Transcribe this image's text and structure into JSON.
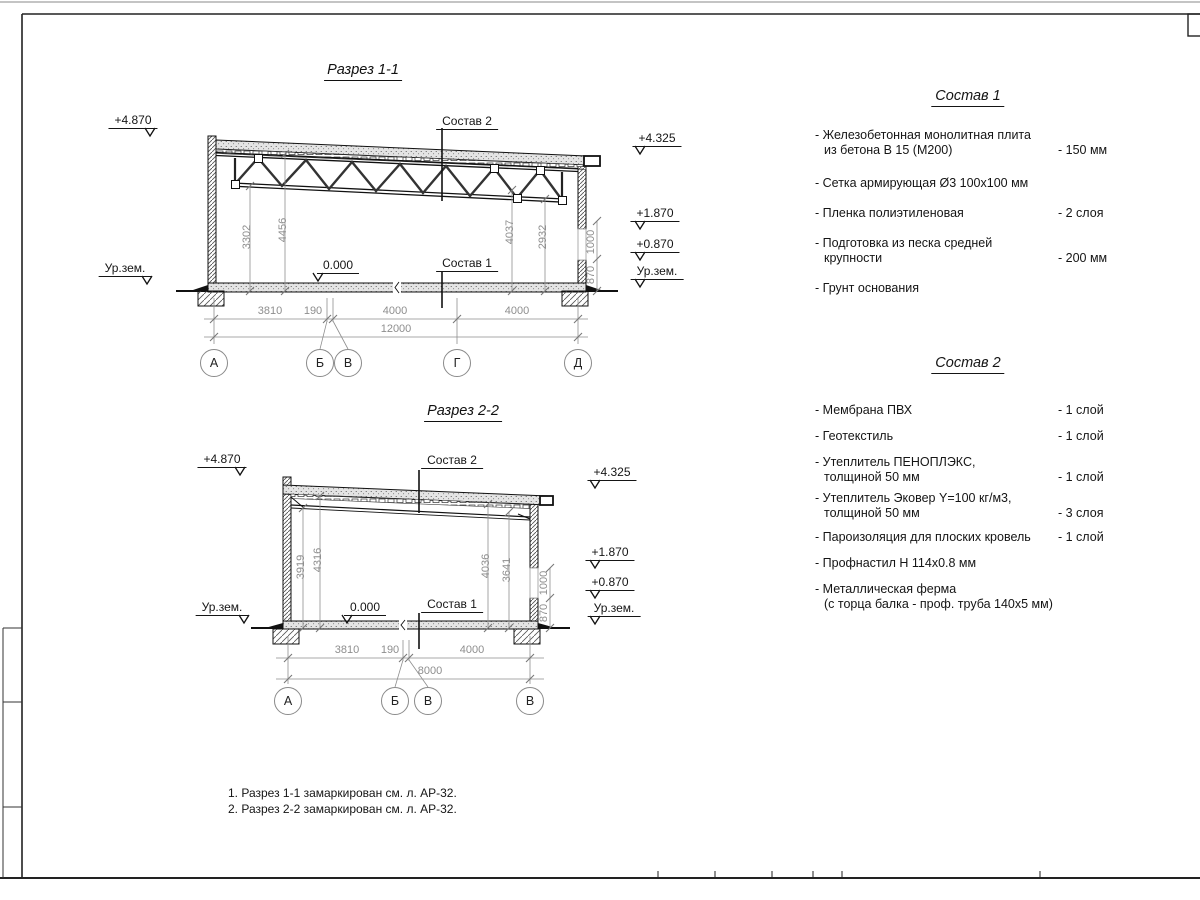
{
  "labels": {
    "ur_zem": "Ур.зем.",
    "zero": "0.000",
    "sostav1_ref": "Состав 1",
    "sostav2_ref": "Состав 2"
  },
  "section1": {
    "title": "Разрез 1-1",
    "elev_left": "+4.870",
    "elev_right_top": "+4.325",
    "elev_right_mid": "+1.870",
    "elev_right_low": "+0.870",
    "vdims": [
      "3302",
      "4456",
      "4037",
      "2932"
    ],
    "wall_dims": [
      "870",
      "1000"
    ],
    "dims": [
      "3810",
      "190",
      "4000",
      "4000"
    ],
    "total": "12000",
    "axes": [
      "А",
      "Б",
      "В",
      "Г",
      "Д"
    ]
  },
  "section2": {
    "title": "Разрез 2-2",
    "elev_left": "+4.870",
    "elev_right_top": "+4.325",
    "elev_right_mid": "+1.870",
    "elev_right_low": "+0.870",
    "vdims": [
      "3919",
      "4316",
      "4036",
      "3641"
    ],
    "wall_dims": [
      "870",
      "1000"
    ],
    "dims": [
      "3810",
      "190",
      "4000"
    ],
    "total": "8000",
    "axes": [
      "А",
      "Б",
      "В",
      "В"
    ]
  },
  "sostav1": {
    "title": "Состав 1",
    "items": [
      {
        "lines": [
          "- Железобетонная  монолитная плита",
          "из бетона В 15 (М200)"
        ],
        "value": "- 150 мм"
      },
      {
        "lines": [
          "- Сетка армирующая Ø3 100х100 мм"
        ],
        "value": ""
      },
      {
        "lines": [
          "- Пленка полиэтиленовая"
        ],
        "value": "-  2 слоя"
      },
      {
        "lines": [
          "- Подготовка из песка средней",
          "крупности"
        ],
        "value": "- 200 мм"
      },
      {
        "lines": [
          "- Грунт основания"
        ],
        "value": ""
      }
    ]
  },
  "sostav2": {
    "title": "Состав 2",
    "items": [
      {
        "lines": [
          "- Мембрана ПВХ"
        ],
        "value": "- 1 слой"
      },
      {
        "lines": [
          "- Геотекстиль"
        ],
        "value": "- 1 слой"
      },
      {
        "lines": [
          "- Утеплитель ПЕНОПЛЭКС,",
          "толщиной 50 мм"
        ],
        "value": "- 1 слой"
      },
      {
        "lines": [
          "- Утеплитель Эковер Y=100 кг/м3,",
          "толщиной 50 мм"
        ],
        "value": "- 3 слоя"
      },
      {
        "lines": [
          "- Пароизоляция для плоских кровель"
        ],
        "value": "- 1 слой"
      },
      {
        "lines": [
          "- Профнастил Н 114х0.8 мм"
        ],
        "value": ""
      },
      {
        "lines": [
          "- Металлическая ферма",
          "(с торца балка - проф. труба 140х5 мм)"
        ],
        "value": ""
      }
    ]
  },
  "notes": [
    "1. Разрез 1-1 замаркирован см. л. АР-32.",
    "2. Разрез 2-2 замаркирован см. л. АР-32."
  ]
}
